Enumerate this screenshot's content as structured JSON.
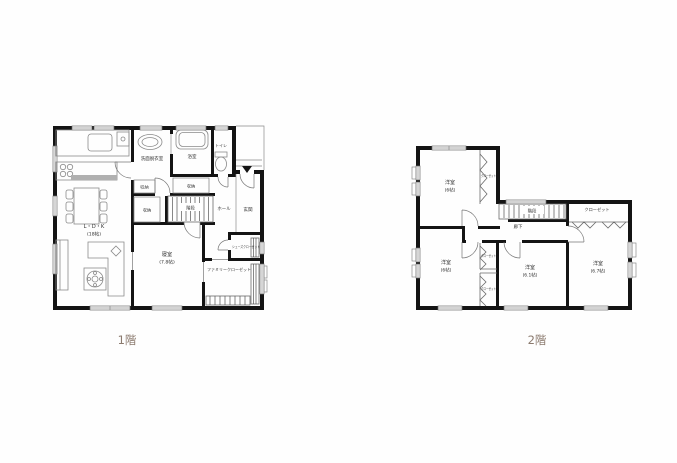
{
  "colors": {
    "wall": "#141414",
    "title_text": "#8b7a6e",
    "counter": "#b0b0b0"
  },
  "floor1": {
    "title": "1階",
    "labels": {
      "ldk": "L・D・K",
      "ldk_size": "(18帖)",
      "bedroom": "寝室",
      "bedroom_size": "(7.8帖)",
      "washroom": "洗面脱衣室",
      "bath": "浴室",
      "toilet": "トイレ",
      "storage_wash": "収納",
      "storage_bath": "収納",
      "storage_hall": "収納",
      "stairs": "階段",
      "hall": "ホール",
      "entrance": "玄関",
      "shoe_closet": "シューズクローゼット",
      "family_closet": "ファミリークローゼット"
    }
  },
  "floor2": {
    "title": "2階",
    "labels": {
      "room_nw": "洋室",
      "room_nw_size": "(6帖)",
      "room_sw": "洋室",
      "room_sw_size": "(6帖)",
      "room_s": "洋室",
      "room_s_size": "(6.1帖)",
      "room_se": "洋室",
      "room_se_size": "(6.7帖)",
      "stairs": "階段",
      "corridor": "廊下",
      "closet_main": "クローゼット",
      "closet_nw": "クローゼット",
      "closet_w1": "クローゼット",
      "closet_w2": "クローゼット"
    }
  }
}
